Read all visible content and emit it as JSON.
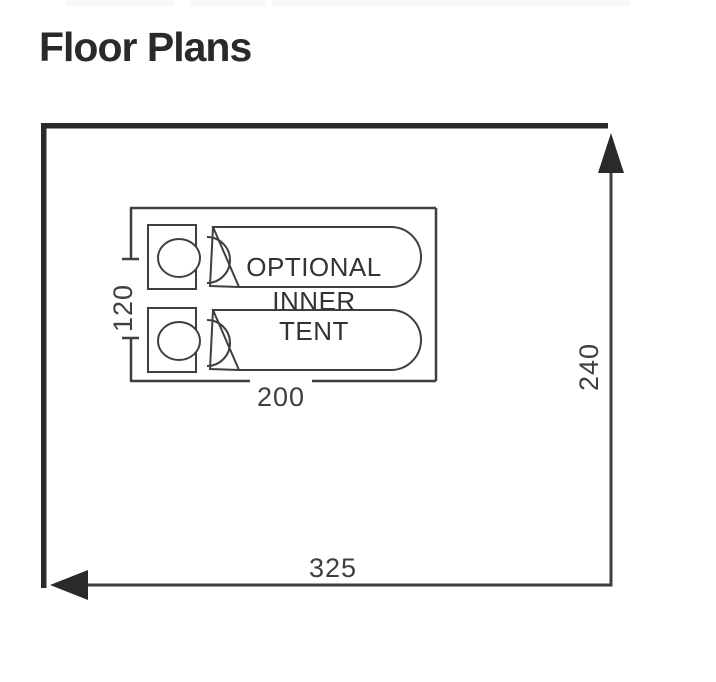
{
  "page": {
    "title": "Floor Plans"
  },
  "diagram": {
    "outer": {
      "width_label": "325",
      "height_label": "240"
    },
    "inner_tent": {
      "width_label": "200",
      "height_label": "120",
      "label_lines": [
        "OPTIONAL",
        "INNER",
        "TENT"
      ]
    },
    "beds_count": "2",
    "colors": {
      "wall": "#2a2a2a",
      "line": "#3f3f3f",
      "text": "#333333",
      "background": "#ffffff"
    }
  }
}
